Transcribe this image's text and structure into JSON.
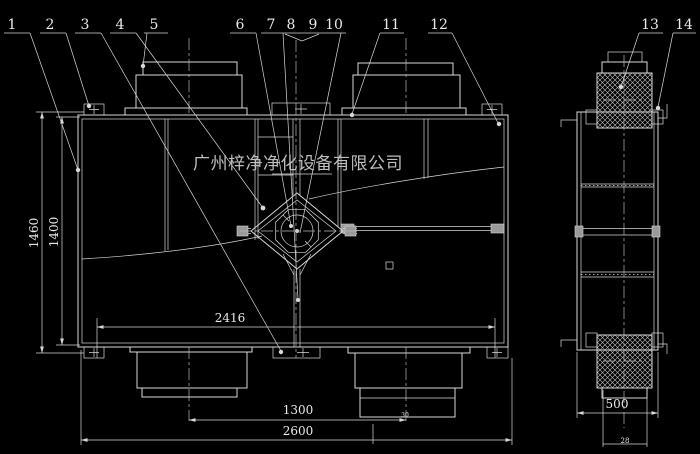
{
  "watermark": "广州梓净净化设备有限公司",
  "callouts": [
    "1",
    "2",
    "3",
    "4",
    "5",
    "6",
    "7",
    "8",
    "9",
    "10",
    "11",
    "12",
    "13",
    "14"
  ],
  "dimensions": {
    "overall_height": "1460",
    "body_height": "1400",
    "inner_width": "2416",
    "duct_spacing": "1300",
    "overall_width": "2600",
    "side_width": "500",
    "side_offset": "30",
    "side_duct": "28"
  },
  "colors": {
    "background": "#000000",
    "line": "#d8d8d8",
    "centerline": "#b8b8b8",
    "dim_text": "#e9e9e9",
    "watermark": "#bfbfbf"
  }
}
